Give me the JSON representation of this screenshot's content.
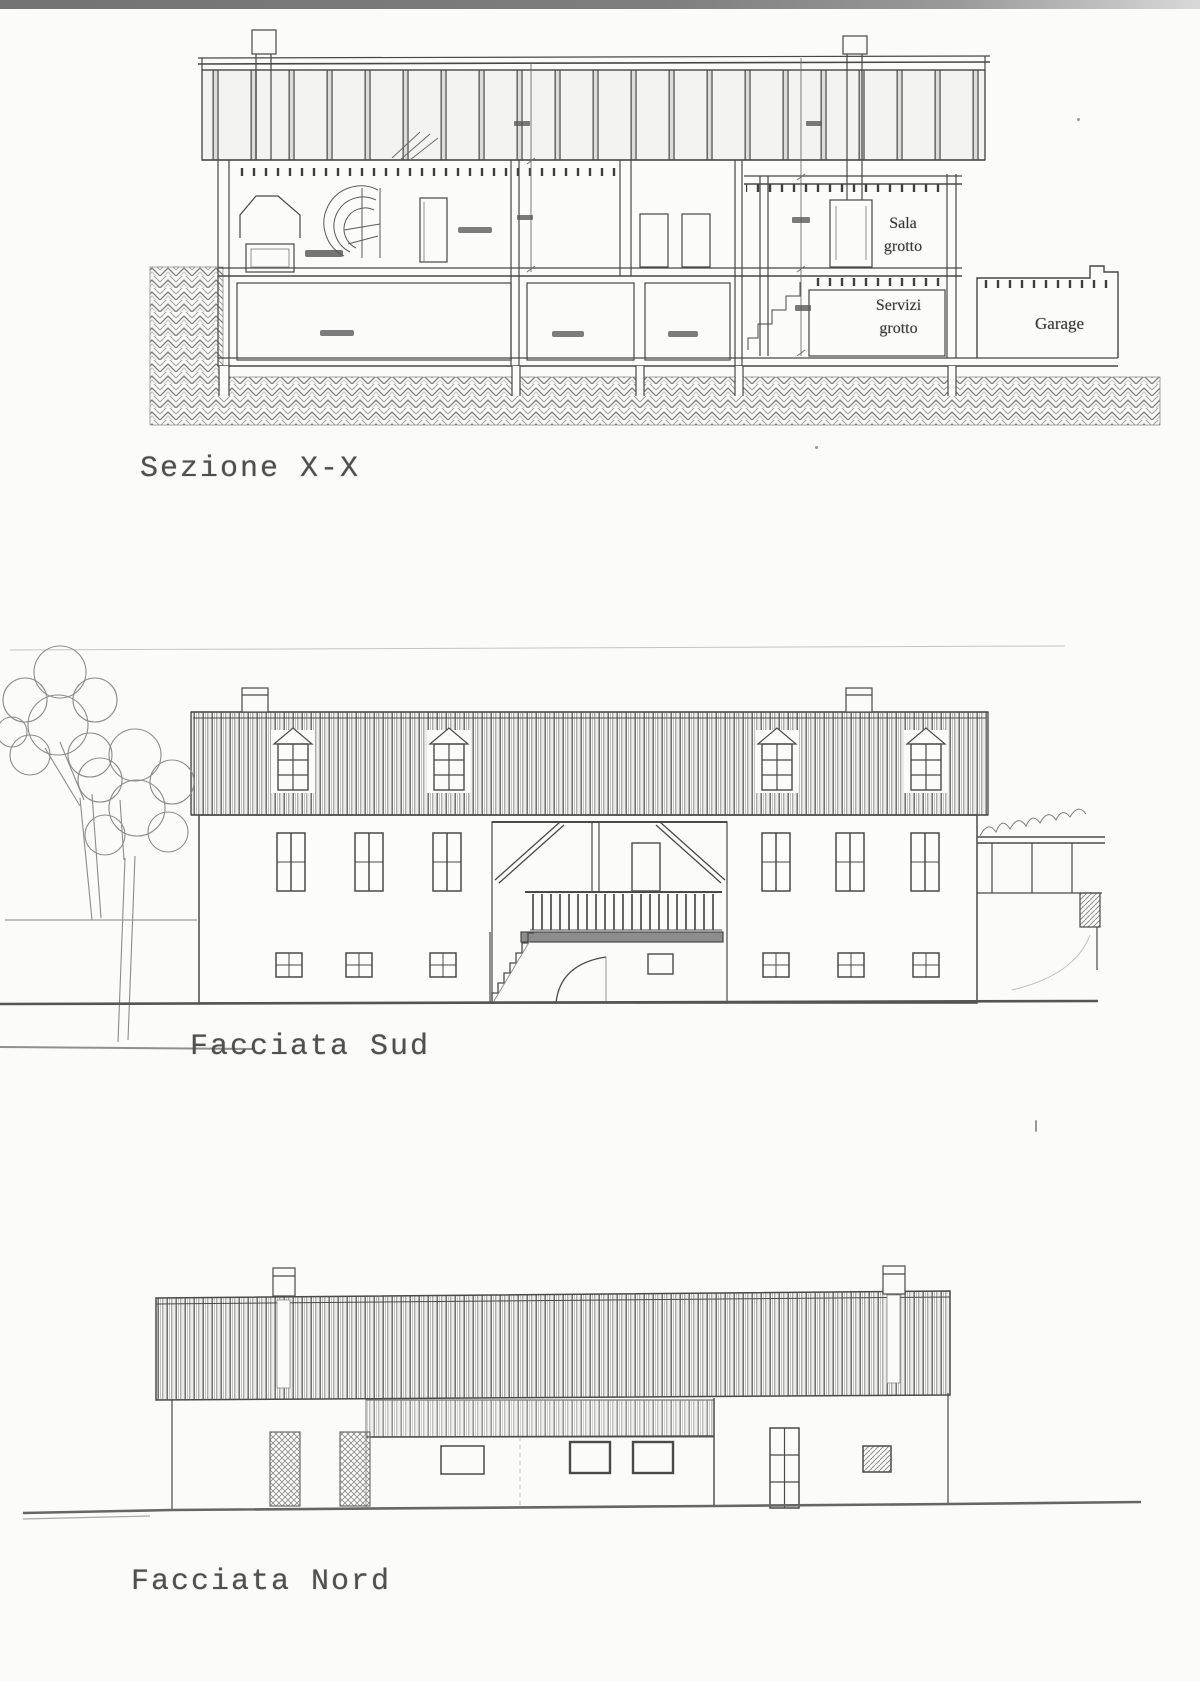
{
  "page": {
    "paper_color": "#fbfbf9",
    "ink_color": "#474747",
    "scanner_strip_color": "#7e7e7e"
  },
  "section": {
    "caption": "Sezione X-X",
    "labels": {
      "sala_grotto": "Sala grotto",
      "servizi_grotto": "Servizi grotto",
      "garage": "Garage"
    }
  },
  "south_facade": {
    "caption": "Facciata Sud"
  },
  "north_facade": {
    "caption": "Facciata Nord"
  }
}
